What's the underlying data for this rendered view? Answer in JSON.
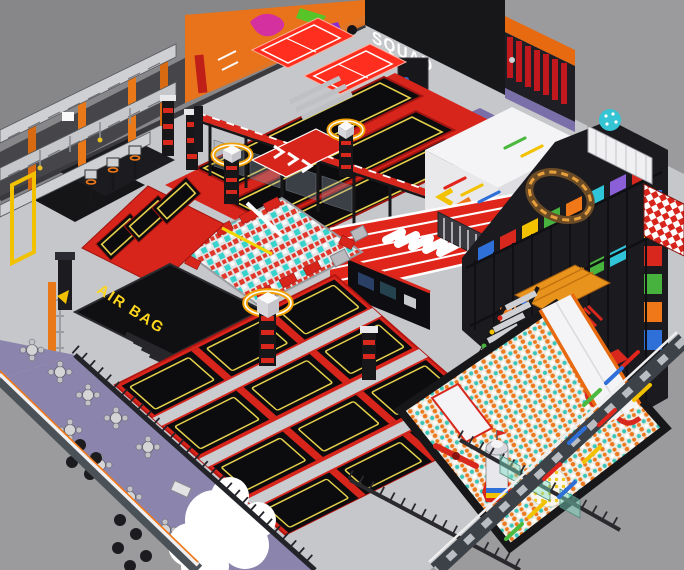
{
  "scene": {
    "type": "3d-isometric-render",
    "subject": "Indoor trampoline park aerial view",
    "signs": {
      "banner_line1": "SQUAD",
      "banner_line2": "UP",
      "airbag": "AIR BAG"
    },
    "palette": {
      "background": "#9b9b9d",
      "floor": "#c6c7ca",
      "wall_gray": "#87878a",
      "wall_dark": "#46464a",
      "graffiti_orange": "#e8731c",
      "banner_black": "#17171a",
      "frame_red": "#d8251c",
      "track_red": "#e0251a",
      "bed_black": "#0c0c0e",
      "stitch_yellow": "#e5d14c",
      "airbag_black": "#101013",
      "airbag_text_yellow": "#ffd61e",
      "cafe_purple": "#8b84ad",
      "foam_cyan": "#38d2cc",
      "foam_red": "#e0392c",
      "ball_orange": "#ee7a1f",
      "ball_teal": "#3cc6ba",
      "structure_orange": "#f07818",
      "slide_white": "#f4f4f6"
    },
    "zones": [
      "ninja-course",
      "dodgeball-courts",
      "squad-up-banner",
      "stage",
      "party-room",
      "playground-structure",
      "ball-pit",
      "running-track",
      "foam-pit",
      "dunk-lanes",
      "air-bag-pit",
      "trampoline-court",
      "cafe-seating",
      "walkway"
    ]
  }
}
